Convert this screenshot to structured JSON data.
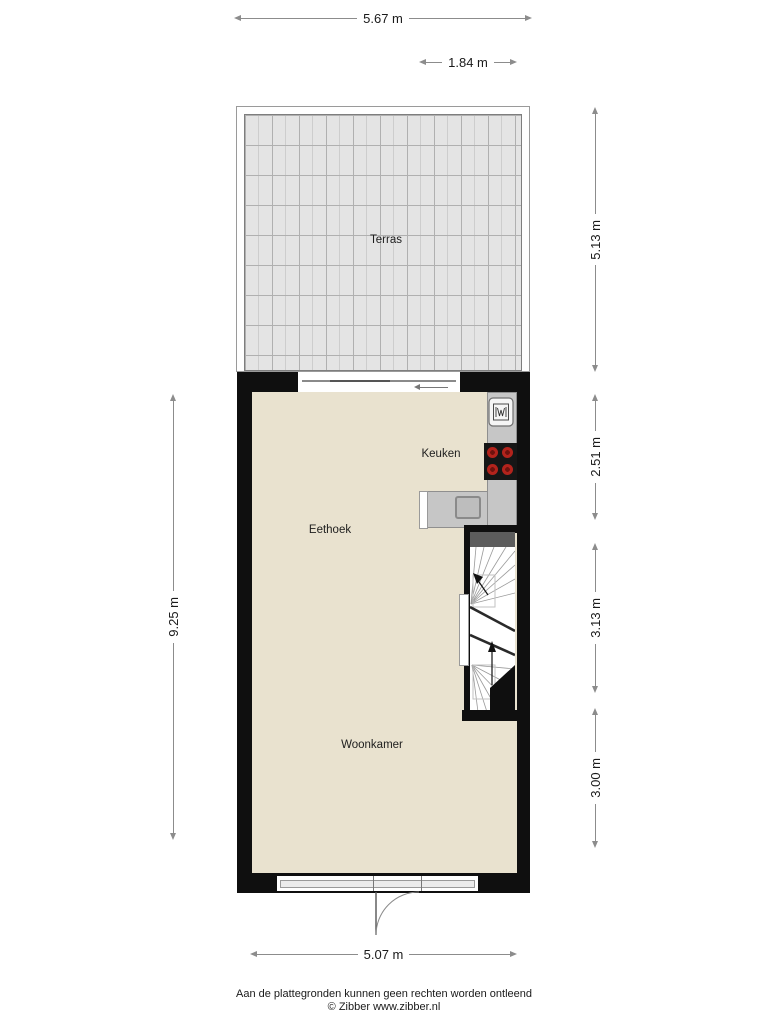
{
  "dimensions": {
    "top_width": "5.67 m",
    "terrace_width": "1.84 m",
    "terrace_depth": "5.13 m",
    "kitchen_depth": "2.51 m",
    "stairs_depth": "3.13 m",
    "living_depth": "3.00 m",
    "house_depth": "9.25 m",
    "bottom_width": "5.07 m"
  },
  "rooms": {
    "terrace": "Terras",
    "kitchen": "Keuken",
    "dining": "Eethoek",
    "living": "Woonkamer"
  },
  "footer": {
    "disclaimer": "Aan de plattegronden kunnen geen rechten worden ontleend",
    "copyright": "© Zibber www.zibber.nl"
  },
  "colors": {
    "wall": "#0f0f0f",
    "floor": "#e9e2cf",
    "terrace_tile": "#e4e4e4",
    "counter": "#c6c6c6",
    "burner_red": "#b3231c",
    "stair_landing": "#5c5c5c",
    "dimension_line": "#8c8c8c"
  }
}
